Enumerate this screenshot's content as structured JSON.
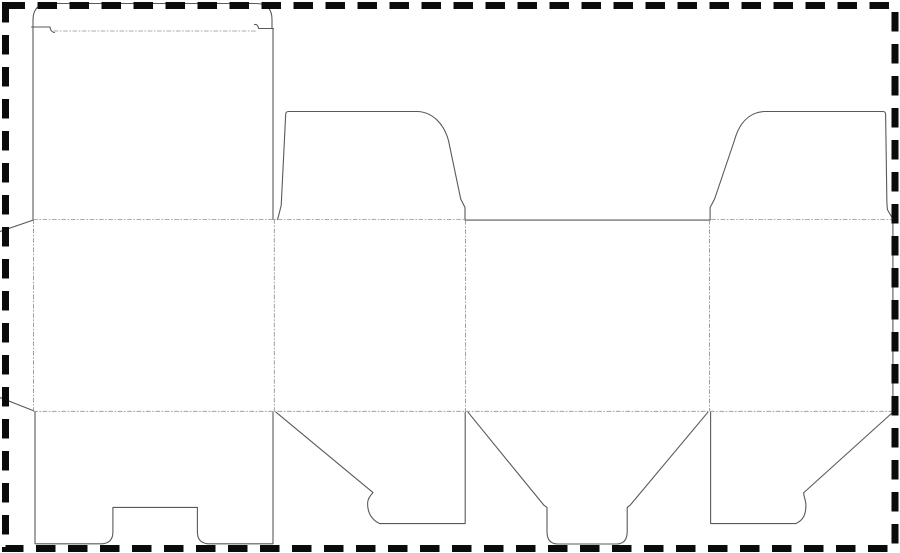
{
  "canvas": {
    "width": 900,
    "height": 553,
    "viewbox": "0 0 900 553",
    "background": "#ffffff"
  },
  "sheet_border": {
    "x": 5.5,
    "y": 5.5,
    "width": 889.5,
    "height": 543,
    "color": "#0b0b0b",
    "stroke_width": 7,
    "dash": "19.5 12.5"
  },
  "line_styles": {
    "cut": {
      "color": "#595959",
      "width": 1.1,
      "dash": ""
    },
    "fold": {
      "color": "#909090",
      "width": 0.85,
      "dash": "4 2.2 1 2.2"
    }
  },
  "dieline": {
    "cut_paths": [
      {
        "name": "tuck-flap-outline",
        "d": "M 33 27 L 33 20 Q 33 3.5 49.5 3.5 L 256 3.5 Q 272 3.5 272 19.5 L 272 28.5"
      },
      {
        "name": "tuck-lock-shoulder-left",
        "d": "M 31.5 27 L 50 27 Q 50.5 32 54.5 32.5"
      },
      {
        "name": "tuck-lock-shoulder-right",
        "d": "M 273.5 28.5 L 258.5 28.5 Q 258 24 254.5 24.5"
      },
      {
        "name": "lid-panel-left-edge",
        "d": "M 33 27 L 33 219.5"
      },
      {
        "name": "lid-panel-right-edge",
        "d": "M 273 28.5 L 273 219.5"
      },
      {
        "name": "glue-flap-top-bevel",
        "d": "M 33.5 220 L 0 231.5"
      },
      {
        "name": "glue-flap-bottom-bevel",
        "d": "M 33.5 410.7 L 0 397.5"
      },
      {
        "name": "dust-flap-left-outline",
        "d": "M 277.5 219.6 C 279.6 212.5 280.2 209 281.2 205.5 L 285.7 114 Q 285.9 111.5 288.5 111.5 L 418 111.5 C 432.5 112.5 443.5 123 448.5 140.5 L 460.7 199 L 465 207.5 L 465 219.7"
      },
      {
        "name": "dust-flap-right-outline",
        "d": "M 892.9 219.2 L 887.4 209.5 L 886.9 203 L 885.6 113.8 Q 885.4 111.5 882.8 111.5 L 764 111.5 C 749.5 112.5 739.3 122.5 734.4 140.5 L 714.6 199 L 710.1 207.5 L 710.1 219.7"
      },
      {
        "name": "front-panel-top-cut",
        "d": "M 464.9 220.1 L 710.2 220.1"
      },
      {
        "name": "sheet-right-edge",
        "d": "M 892.9 219.2 L 892.9 411.4"
      },
      {
        "name": "bottom-flap-back-outline",
        "d": "M 35 411.8 L 35 543.8 L 102.5 543.8 Q 112.9 542.8 112.9 532 L 112.9 507.4 L 197.4 507.4 L 197.4 532 Q 197.4 542.8 207.8 543.8 L 273 543.8 L 273 411.8"
      },
      {
        "name": "bottom-flap-side1-outline",
        "d": "M 276 412.2 L 373 492.6 C 370.2 495.4 367.6 498.8 367.6 503.4 C 367.6 511.8 370.2 519.2 379.8 523.6 L 465.2 523.6 L 465.2 412.2"
      },
      {
        "name": "bottom-flap-front-outline",
        "d": "M 468 412.2 L 543.6 504.9 L 547 507.4 L 547 531.5 Q 547 544 557.8 544 L 616.4 544 Q 627.2 544 627.2 531.5 L 627.2 507.4 L 630.4 504.9 L 707.9 412.2"
      },
      {
        "name": "bottom-flap-side2-outline",
        "d": "M 710.6 412.2 L 710.6 523.6 L 795.8 523.6 C 803.6 520.2 805.9 514 805.9 505.2 C 805.9 499.6 803.3 496.4 803.8 492.6 L 892.9 412.2"
      }
    ],
    "fold_lines": [
      {
        "name": "tuck-flap-fold",
        "d": "M 54 31 L 255.5 31"
      },
      {
        "name": "top-fold-left",
        "d": "M 33.5 219.5 L 463.5 219.5"
      },
      {
        "name": "top-fold-right",
        "d": "M 711.5 219.5 L 892.5 219.5"
      },
      {
        "name": "bottom-fold",
        "d": "M 33.5 411.3 L 892.5 411.3"
      },
      {
        "name": "glue-flap-fold",
        "d": "M 33.5 219.5 L 33.5 410.8"
      },
      {
        "name": "fold-back-side1",
        "d": "M 274.3 219.5 L 274.3 411"
      },
      {
        "name": "fold-side1-front",
        "d": "M 465.6 220.3 L 465.6 411"
      },
      {
        "name": "fold-front-side2",
        "d": "M 709.5 220.3 L 709.5 411"
      }
    ]
  }
}
